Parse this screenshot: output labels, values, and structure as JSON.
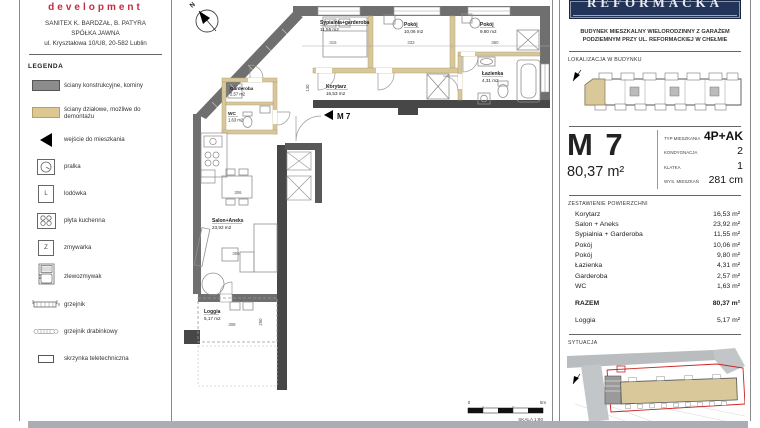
{
  "sidebar": {
    "logo": "development",
    "company": [
      "SANITEX K. BARDZAŁ, B. PATYRA",
      "SPÓŁKA JAWNA",
      "ul. Kryształowa 10/U8, 20-582 Lublin"
    ],
    "legend_title": "LEGENDA",
    "legend": [
      {
        "icon": "structural-wall-swatch",
        "label": "ściany konstrukcyjne, kominy"
      },
      {
        "icon": "partition-wall-swatch",
        "label": "ściany działowe, możliwe do demontażu"
      },
      {
        "icon": "entrance-triangle",
        "label": "wejście do mieszkania"
      },
      {
        "icon": "washer-icon",
        "label": "pralka"
      },
      {
        "icon": "fridge-icon",
        "label": "lodówka"
      },
      {
        "icon": "hob-icon",
        "label": "płyta kuchenna"
      },
      {
        "icon": "dishwasher-icon",
        "label": "zmywarka"
      },
      {
        "icon": "sink-icon",
        "label": "zlewozmywak"
      },
      {
        "icon": "radiator-icon",
        "label": "grzejnik"
      },
      {
        "icon": "towel-radiator-icon",
        "label": "grzejnik drabinkowy"
      },
      {
        "icon": "telecom-box-icon",
        "label": "skrzynka teletechniczna"
      }
    ],
    "fridge_letter": "L",
    "dishwasher_letter": "Z"
  },
  "plan": {
    "north_label": "N",
    "entrance_label": "M 7",
    "rooms": [
      {
        "name": "Sypialnia+garderoba",
        "area": "11,55 m2"
      },
      {
        "name": "Pokój",
        "area": "10,06 m2"
      },
      {
        "name": "Pokój",
        "area": "9,80 m2"
      },
      {
        "name": "Łazienka",
        "area": "4,31 m2"
      },
      {
        "name": "Korytarz",
        "area": "16,53 m2"
      },
      {
        "name": "Garderoba",
        "area": "2,57 m2"
      },
      {
        "name": "WC",
        "area": "1,63 m2"
      },
      {
        "name": "Salon+Aneks",
        "area": "23,92 m2"
      },
      {
        "name": "Loggia",
        "area": "5,17 m2"
      }
    ],
    "dims": [
      "315",
      "333",
      "360",
      "130",
      "306",
      "306",
      "308",
      "250"
    ],
    "scale": {
      "start": "0",
      "end": "5m",
      "label": "SKALA 1:80"
    }
  },
  "panel": {
    "logo_text": "REFORMACKA",
    "description": [
      "BUDYNEK MIESZKALNY WIELORODZINNY Z GARAŻEM",
      "PODZIEMNYM PRZY UL. REFORMACKIEJ W CHEŁMIE"
    ],
    "location_title": "LOKALIZACJA W BUDYNKU",
    "unit": {
      "code": "M 7",
      "area": "80,37 m²",
      "specs": [
        {
          "label": "TYP MIESZKANIA",
          "value": "4P+AK"
        },
        {
          "label": "KONDYGNACJA",
          "value": "2"
        },
        {
          "label": "KLATKA",
          "value": "1"
        },
        {
          "label": "WYS. MIESZKAŃ",
          "value": "281 cm"
        }
      ]
    },
    "areas_title": "ZESTAWIENIE POWIERZCHNI",
    "areas": [
      {
        "name": "Korytarz",
        "value": "16,53 m²"
      },
      {
        "name": "Salon + Aneks",
        "value": "23,92 m²"
      },
      {
        "name": "Sypialnia + Garderoba",
        "value": "11,55 m²"
      },
      {
        "name": "Pokój",
        "value": "10,06 m²"
      },
      {
        "name": "Pokój",
        "value": "9,80 m²"
      },
      {
        "name": "Łazienka",
        "value": "4,31 m²"
      },
      {
        "name": "Garderoba",
        "value": "2,57 m²"
      },
      {
        "name": "WC",
        "value": "1,63 m²"
      }
    ],
    "total": {
      "name": "RAZEM",
      "value": "80,37 m²"
    },
    "loggia": {
      "name": "Loggia",
      "value": "5,17 m²"
    },
    "situation_title": "SYTUACJA"
  },
  "colors": {
    "accent_red": "#c62b3f",
    "navy": "#223459",
    "partition_beige": "#d8c79a",
    "wall_gray": "#6f6f6f",
    "wall_dark": "#474747",
    "boundary_red": "#cc2222"
  }
}
